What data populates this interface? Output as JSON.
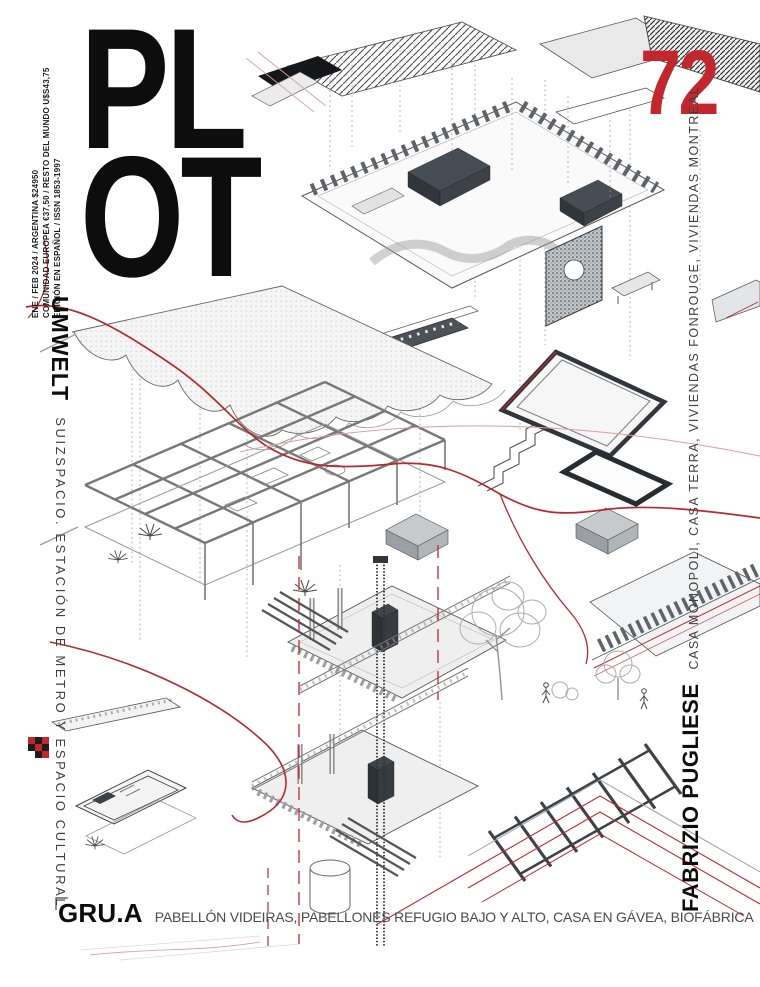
{
  "masthead": {
    "line1": "PL",
    "line2": "OT",
    "issue": "72"
  },
  "edition_info": {
    "line1": "ENE / FEB 2024 / ARGENTINA $24950",
    "line2": "COMUNIDAD EUROPEA €37,50 / RESTO DEL MUNDO U$S43,75",
    "line3": "EDICIÓN EN ESPAÑOL / ISSN 1853-1997"
  },
  "features": {
    "left": {
      "studio": "UMWELT",
      "projects": "SUIZSPACIO. ESTACIÓN DE METRO Y ESPACIO CULTURAL"
    },
    "right": {
      "studio": "FABRIZIO PUGLIESE",
      "projects": "CASA MONOPOLI, CASA TERRA, VIVIENDAS FONROUGE, VIVIENDAS MONTREAL"
    },
    "bottom": {
      "studio": "GRU.A",
      "projects": "PABELLÓN VIDEIRAS, PABELLONES REFUGIO BAJO Y ALTO, CASA EN GÁVEA, BIOFÁBRICA"
    }
  },
  "colors": {
    "accent_red": "#c1272d",
    "ink": "#0d0d0d",
    "text_gray": "#3f3f3f",
    "line_gray": "#555555"
  },
  "artwork": {
    "elements": [
      "hatched-roof-plane",
      "slatted-pavilion-axon",
      "wavy-shell-roof",
      "grid-frame-house-axon",
      "construction-assembly-axon",
      "stair-fragment",
      "speckled-wall-panel",
      "terrace-frame",
      "pergola-frame",
      "tree-sketch",
      "red-flow-lines",
      "red-dashed-guides",
      "dotted-guide-lines",
      "pixel-marks"
    ]
  }
}
